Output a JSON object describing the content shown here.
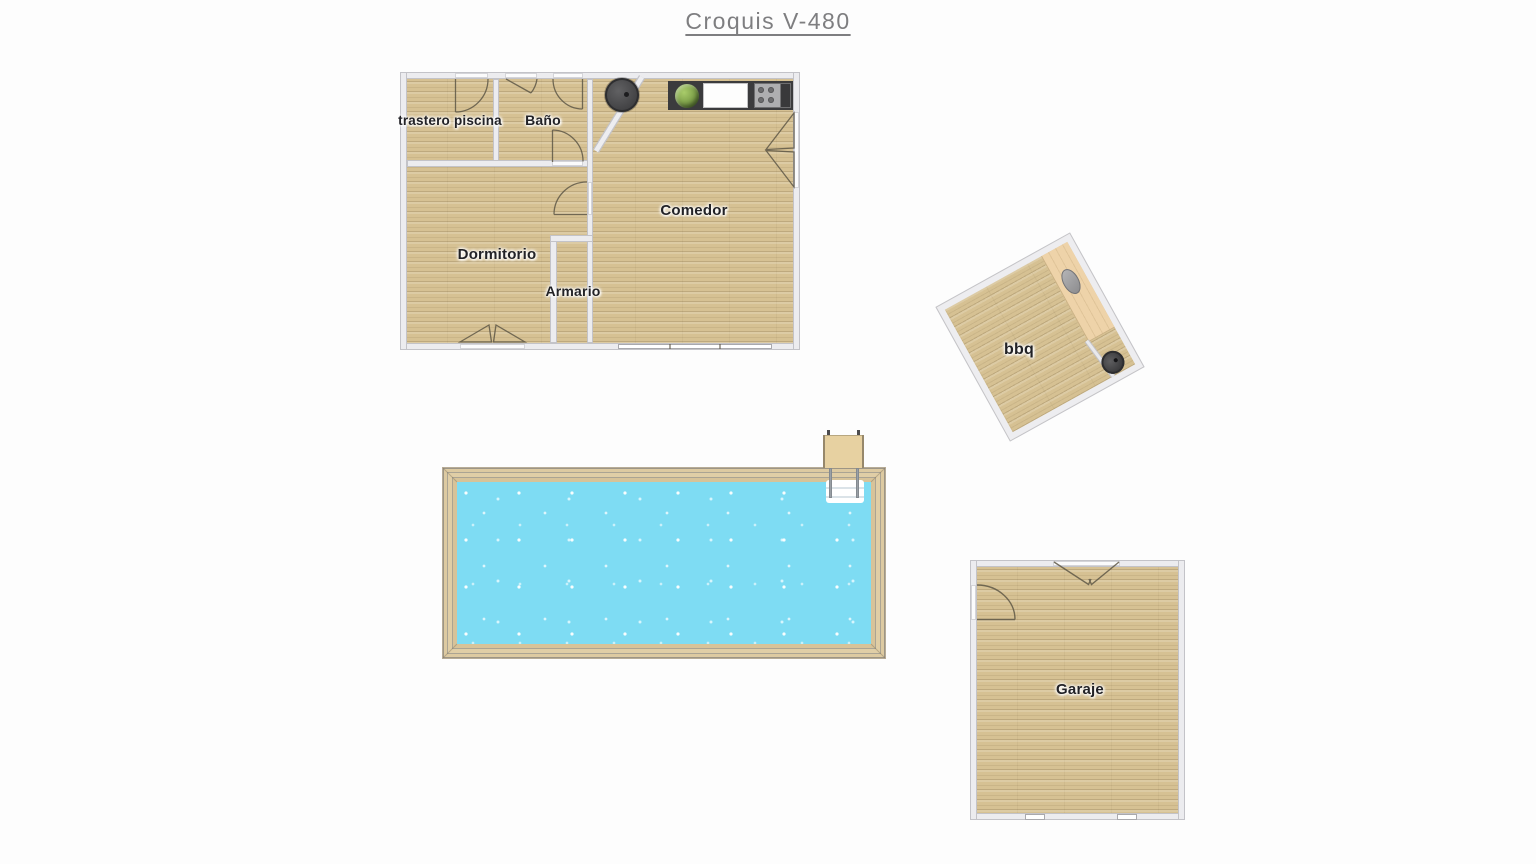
{
  "title": "Croquis V-480",
  "rooms": {
    "trastero": {
      "label": "trastero piscina"
    },
    "bano": {
      "label": "Baño"
    },
    "comedor": {
      "label": "Comedor"
    },
    "dormitorio": {
      "label": "Dormitorio"
    },
    "armario": {
      "label": "Armario"
    },
    "bbq": {
      "label": "bbq"
    },
    "garaje": {
      "label": "Garaje"
    }
  },
  "colors": {
    "floor": "#d6c193",
    "wall": "#ececef",
    "wall-edge": "#c3c3c8",
    "water": "#7edcf3",
    "frame": "#d9c69c",
    "counter": "#3b3b3d",
    "title": "#7e7e80"
  },
  "icons": {
    "plant": "green-foliage-circle",
    "kitchen-sink": "white-rect",
    "cooktop": "gray-rect-four-burners",
    "wood-stove": "dark-circle",
    "bbq-grill": "dark-circle",
    "bbq-sink": "gray-oval",
    "pool-ladder": "platform-rails-steps"
  }
}
